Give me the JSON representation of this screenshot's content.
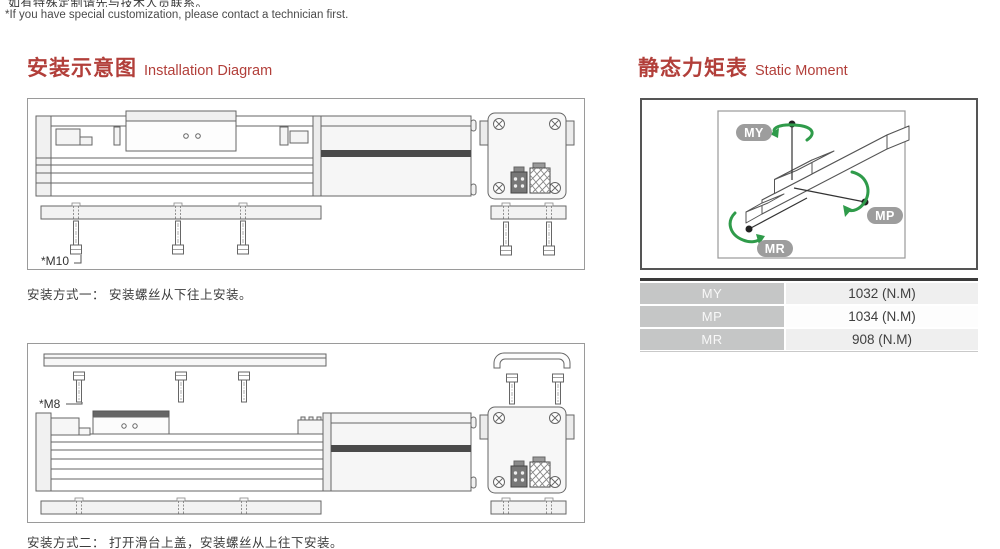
{
  "notes": {
    "zh": "如有特殊定制请先与技术人员联系。",
    "en": "*If you have special customization, please contact a technician first."
  },
  "installation": {
    "title_zh": "安装示意图",
    "title_en": "Installation Diagram",
    "method1": {
      "screw_label": "*M10",
      "caption": "安装方式一： 安装螺丝从下往上安装。"
    },
    "method2": {
      "screw_label": "*M8",
      "caption": "安装方式二： 打开滑台上盖，安装螺丝从上往下安装。"
    }
  },
  "static_moment": {
    "title_zh": "静态力矩表",
    "title_en": "Static Moment",
    "labels": {
      "my": "MY",
      "mp": "MP",
      "mr": "MR"
    },
    "table": {
      "rows": [
        {
          "label": "MY",
          "value": "1032 (N.M)"
        },
        {
          "label": "MP",
          "value": "1034 (N.M)"
        },
        {
          "label": "MR",
          "value": "908 (N.M)"
        }
      ]
    }
  },
  "colors": {
    "heading_red": "#b23f3a",
    "arrow_green": "#2f9b4a",
    "pill_gray": "#9d9d9d",
    "table_label_bg": "#c5c6c6",
    "table_top_bar": "#3a3a3a"
  }
}
